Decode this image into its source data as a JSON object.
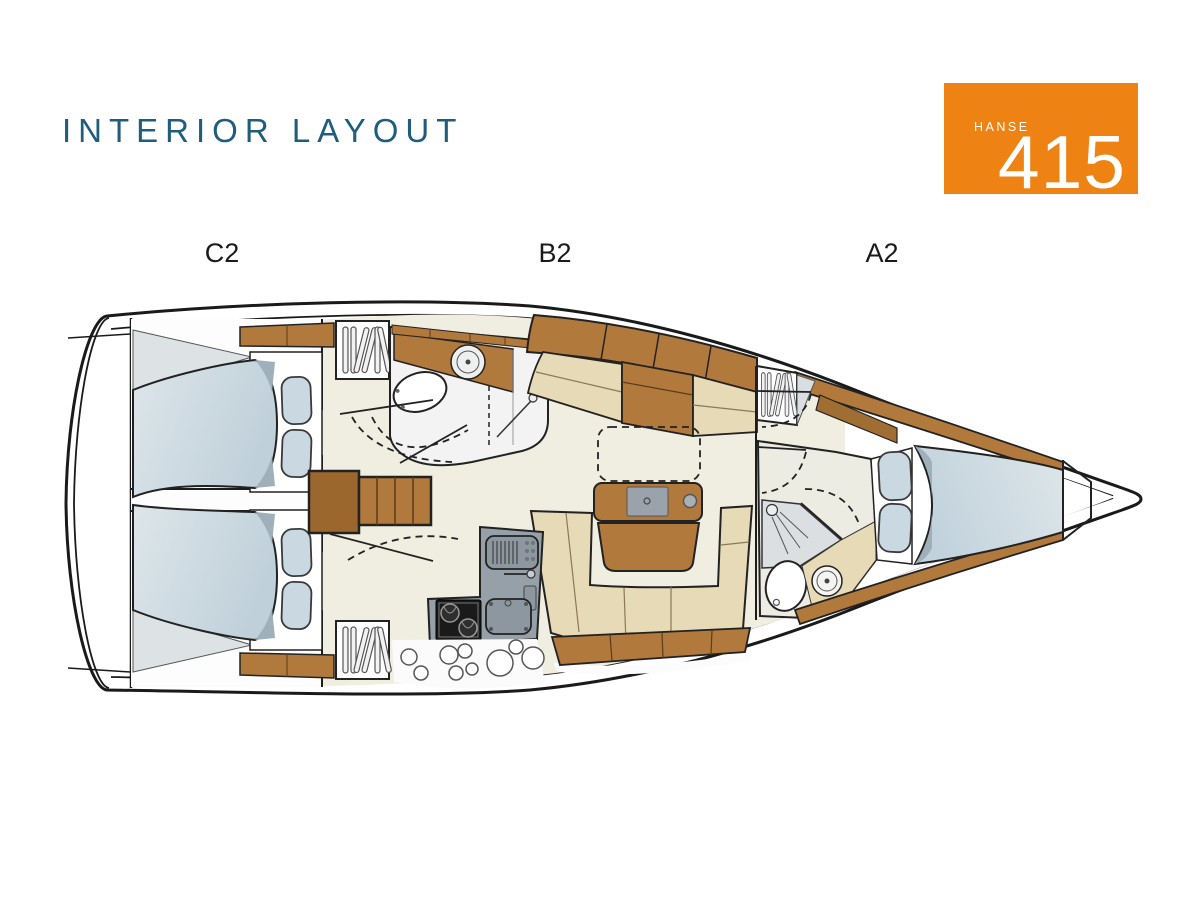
{
  "header": {
    "title": "INTERIOR LAYOUT"
  },
  "badge": {
    "brand": "HANSE",
    "model": "415"
  },
  "plan_labels": {
    "left": "C2",
    "center": "B2",
    "right": "A2"
  },
  "colors": {
    "title": "#1F5D7D",
    "badge_bg": "#EE8313",
    "badge_text": "#FFFFFF",
    "label_text": "#1A1A1A",
    "wood": "#B1793C",
    "upholstery_beige": "#E7DAB6",
    "mattress_blue": "#C9D8E1",
    "counter_grey": "#96A0A8",
    "floor_cream": "#F0EEE0",
    "outline": "#1C1C1C"
  }
}
